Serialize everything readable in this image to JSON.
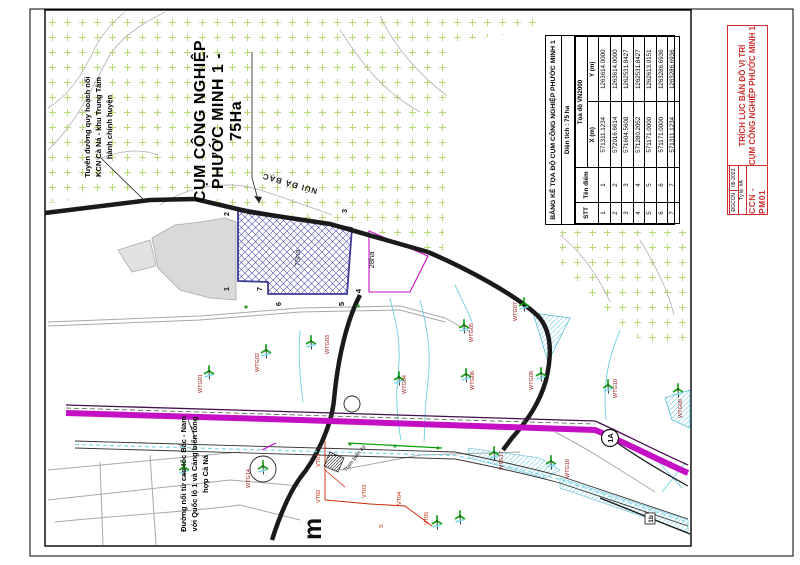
{
  "sheet": {
    "big_title": {
      "line1": "CỤM CÔNG NGHIỆP",
      "line2": "PHƯỚC MINH 1 -",
      "line3": "75Ha"
    },
    "note_planned_road": {
      "line1": "Tuyến đường quy hoạch nối",
      "line2": "KCN Cà Ná - khu Trung Tâm",
      "line3": "hành chính huyện"
    },
    "note_expressway": {
      "line1": "Đường nối từ cao tốc Bắc - Nam",
      "line2": "với Quốc lộ 1 và Cảng biển tổng",
      "line3": "hợp Cà Ná"
    }
  },
  "coord_table": {
    "title": "BẢNG KÊ TỌA ĐỘ CỤM CÔNG NGHIỆP PHƯỚC MINH 1",
    "area_line": "Diện tích : 75 ha",
    "col_stt": "STT",
    "col_point": "Tên điểm",
    "col_group": "Tọa độ VN2000",
    "col_x": "X (m)",
    "col_y": "Y (m)",
    "rows": [
      {
        "stt": "1",
        "point": "1",
        "x": "571311.1234",
        "y": "1263614.0000"
      },
      {
        "stt": "2",
        "point": "2",
        "x": "572016.6614",
        "y": "1263614.0000"
      },
      {
        "stt": "3",
        "point": "3",
        "x": "571604.5608",
        "y": "1262531.8427"
      },
      {
        "stt": "4",
        "point": "4",
        "x": "571280.2052",
        "y": "1262531.8427"
      },
      {
        "stt": "5",
        "point": "5",
        "x": "571171.0000",
        "y": "1262613.0151"
      },
      {
        "stt": "6",
        "point": "6",
        "x": "571171.0000",
        "y": "1263286.6936"
      },
      {
        "stt": "7",
        "point": "7",
        "x": "571311.1234",
        "y": "1263286.6936"
      }
    ]
  },
  "title_block": {
    "line1": "TRÍCH LỤC BẢN ĐỒ VỊ TRÍ",
    "line2": "CỤM CÔNG NGHIỆP PHƯỚC MINH 1",
    "code": "CCN - PM01",
    "cell_author": "ĐGCCN",
    "cell_date": "06-2022",
    "cell_scale": "Tỷ lệ: #A"
  },
  "map": {
    "mountain": "NÚI ĐÁ BẠC",
    "area_75": "75ha",
    "area_28": "28ha",
    "shield": "1A",
    "road_box": "1b",
    "s_mark": "S",
    "big_letter": "m",
    "substation": "Trạm biến áp",
    "vertices": [
      {
        "label": "1",
        "x": 229,
        "y": 289
      },
      {
        "label": "2",
        "x": 229,
        "y": 214
      },
      {
        "label": "3",
        "x": 347,
        "y": 211
      },
      {
        "label": "4",
        "x": 361,
        "y": 291
      },
      {
        "label": "5",
        "x": 344,
        "y": 304
      },
      {
        "label": "6",
        "x": 281,
        "y": 304
      },
      {
        "label": "7",
        "x": 262,
        "y": 289
      }
    ],
    "turbines": [
      {
        "id": "WTG01",
        "x": 209,
        "y": 371,
        "lx": 202,
        "ly": 393
      },
      {
        "id": "WTG02",
        "x": 266,
        "y": 350,
        "lx": 259,
        "ly": 372
      },
      {
        "id": "WTG03",
        "x": 311,
        "y": 341,
        "lx": 329,
        "ly": 354
      },
      {
        "id": "WTG04",
        "x": 399,
        "y": 377,
        "lx": 406,
        "ly": 394
      },
      {
        "id": "WTG05",
        "x": 464,
        "y": 325,
        "lx": 473,
        "ly": 342
      },
      {
        "id": "WTG06",
        "x": 466,
        "y": 374,
        "lx": 474,
        "ly": 390
      },
      {
        "id": "WTG07",
        "x": 524,
        "y": 303,
        "lx": 517,
        "ly": 321
      },
      {
        "id": "WTG08",
        "x": 541,
        "y": 373,
        "lx": 533,
        "ly": 390
      },
      {
        "id": "WTG10",
        "x": 608,
        "y": 385,
        "lx": 617,
        "ly": 398
      },
      {
        "id": "WTG09",
        "x": 678,
        "y": 389,
        "lx": 682,
        "ly": 418
      },
      {
        "id": "WTG14",
        "x": 263,
        "y": 466,
        "lx": 250,
        "ly": 488,
        "circled": true
      },
      {
        "id": "WTG17",
        "x": 494,
        "y": 452,
        "lx": 503,
        "ly": 470
      },
      {
        "id": "WTG18",
        "x": 551,
        "y": 461,
        "lx": 569,
        "ly": 478
      },
      {
        "id": "",
        "x": 437,
        "y": 521
      },
      {
        "id": "",
        "x": 460,
        "y": 516
      },
      {
        "id": "",
        "x": 184,
        "y": 467
      }
    ],
    "vt_points": [
      {
        "label": "VT01",
        "x": 320,
        "y": 467
      },
      {
        "label": "VT02",
        "x": 320,
        "y": 503
      },
      {
        "label": "VT03",
        "x": 366,
        "y": 498
      },
      {
        "label": "VT04",
        "x": 401,
        "y": 505
      },
      {
        "label": "VT05",
        "x": 428,
        "y": 525
      }
    ]
  },
  "colors": {
    "accent_red": "#cf2e2e",
    "magenta_road": "#c50fc5",
    "hatch_blue": "#3c3c96",
    "turbine_green": "#16a016",
    "label_dark_red": "#9b1010",
    "vegetation_green": "#b8d878",
    "water_cyan": "#6fcfe4"
  }
}
